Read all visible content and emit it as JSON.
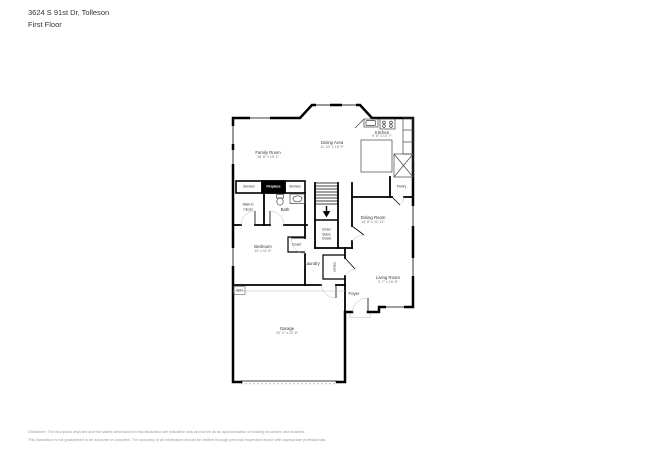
{
  "header": {
    "address": "3624 S 91st Dr, Tolleson",
    "floor": "First Floor"
  },
  "rooms": {
    "family_room": {
      "name": "Family Room",
      "dims": "15' 8\" x 15' 1\""
    },
    "dining_area": {
      "name": "Dining Area",
      "dims": "11' 10\" x 15' 9\""
    },
    "kitchen": {
      "name": "Kitchen",
      "dims": "9' 8\" x 10' 7\""
    },
    "dining_room": {
      "name": "Dining Room",
      "dims": "14' 8\" x 12' 11\""
    },
    "bedroom": {
      "name": "Bedroom",
      "dims": "10' x 11' 6\""
    },
    "living_room": {
      "name": "Living Room",
      "dims": "9' 7\" x 10' 8\""
    },
    "garage": {
      "name": "Garage",
      "dims": "20' 2\" x 20' 8\""
    }
  },
  "labels": {
    "pantry": "Pantry",
    "shelves_left": "Shelves",
    "fireplace": "Fireplace",
    "shelves_right": "Shelves",
    "walk_in_line1": "Walk-in",
    "walk_in_line2": "Closet",
    "bath": "Bath",
    "under_stairs_line1": "Under",
    "under_stairs_line2": "Stairs",
    "under_stairs_line3": "Closet",
    "closet_bedroom": "Closet",
    "laundry": "Laundry",
    "closet_foyer": "Closet",
    "foyer": "Foyer",
    "wh": "W/H"
  },
  "footer": {
    "line1": "Disclaimer: The floorplans depicted and the stated dimensions in this illustration are indicative only and serve as an approximation of existing structures and features.",
    "line2": "This illustration is not guaranteed to be accurate or complete. The accuracy of all information should be verified through personal inspection and/or with appropriate professionals."
  },
  "colors": {
    "wall": "#000000",
    "label_text": "#333333",
    "dim_text": "#777777",
    "disclaimer_text": "#999999"
  }
}
